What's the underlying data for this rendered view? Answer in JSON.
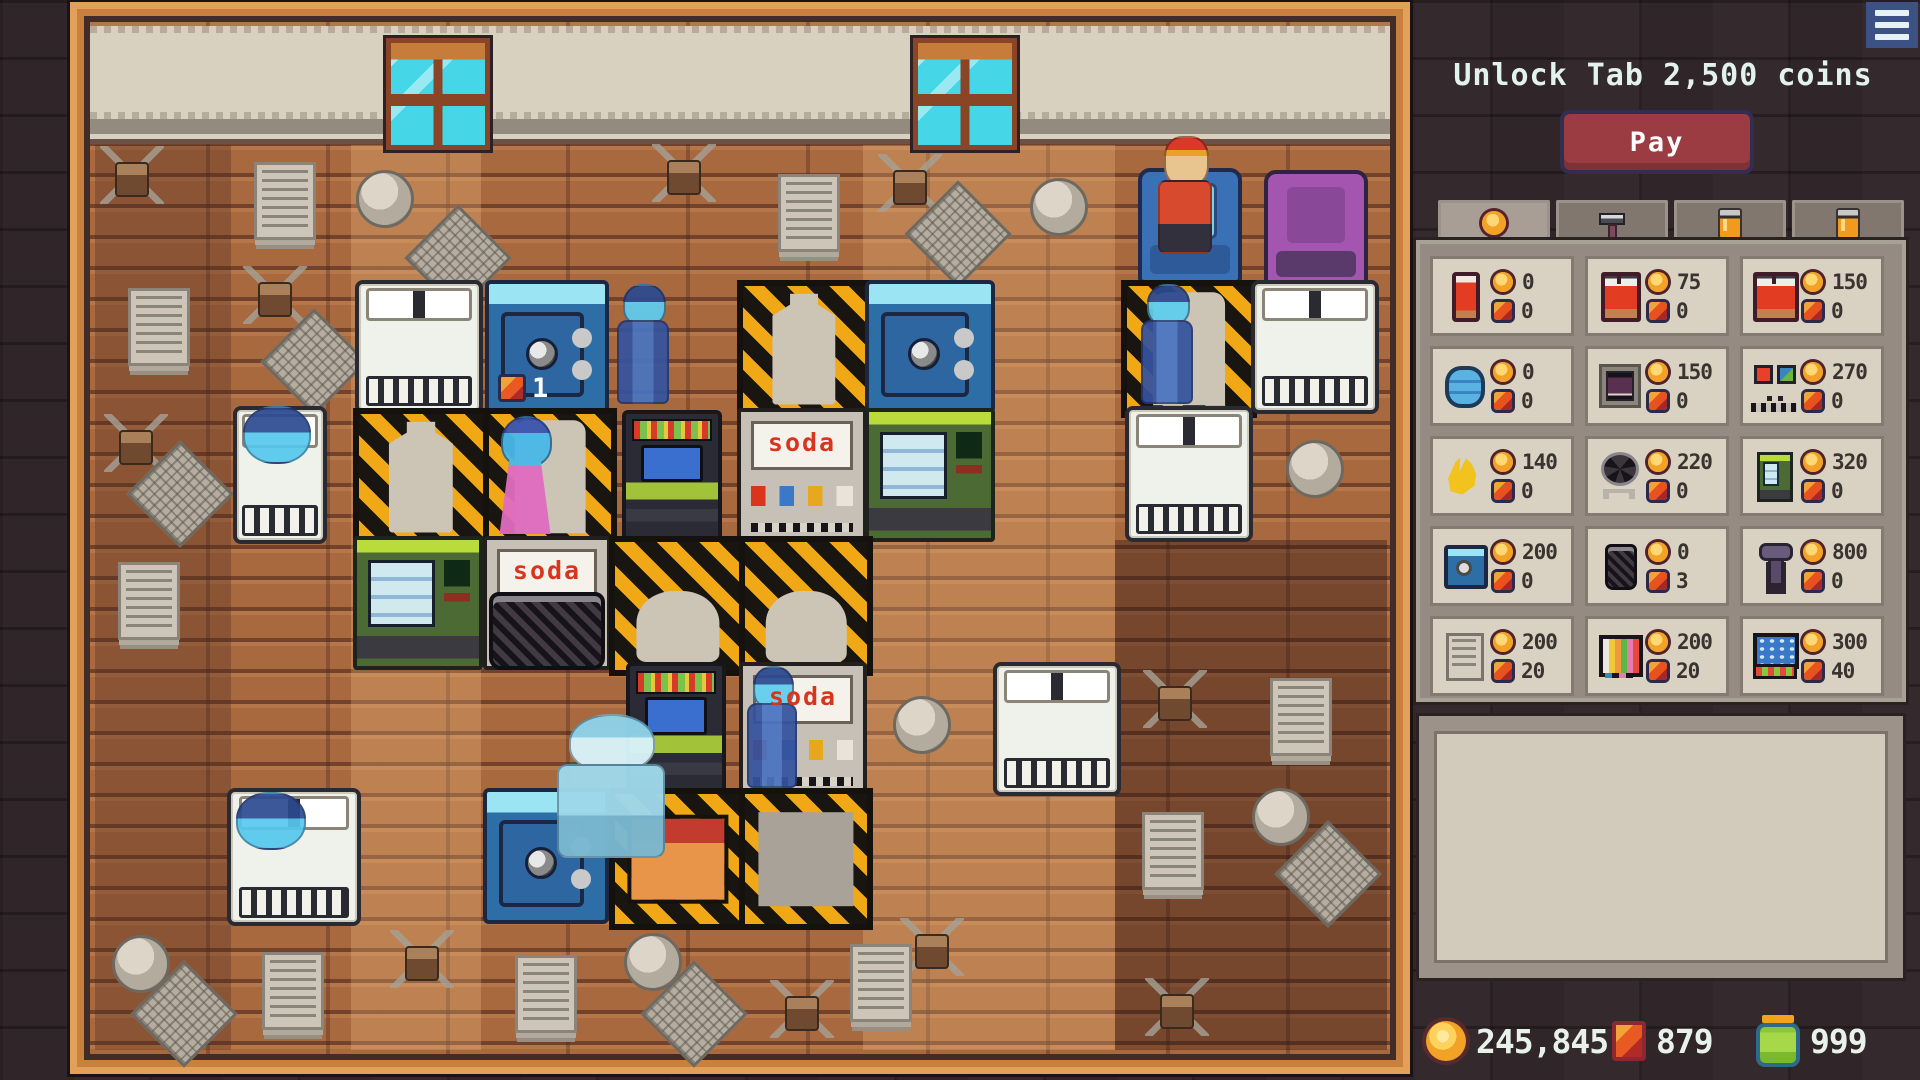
{
  "header": {
    "unlock_text": "Unlock Tab 2,500 coins",
    "pay_label": "Pay"
  },
  "menu": {
    "icon": "hamburger"
  },
  "colors": {
    "accent_orange": "#f2a227",
    "gem_red": "#e85a22",
    "pay_red": "#9a3c42",
    "frame_orange": "#c8803f"
  },
  "tabs": [
    {
      "id": "coins",
      "icon": "coin",
      "active": true
    },
    {
      "id": "tools",
      "icon": "hammer",
      "active": false
    },
    {
      "id": "canister-1",
      "icon": "can",
      "active": false
    },
    {
      "id": "canister-2",
      "icon": "can",
      "active": false
    }
  ],
  "shop": {
    "items": [
      {
        "id": "bedroll",
        "icon": "bedroll",
        "coin": "0",
        "gem": "0"
      },
      {
        "id": "red-bed",
        "icon": "bed",
        "coin": "75",
        "gem": "0"
      },
      {
        "id": "red-double-bed",
        "icon": "bigbed",
        "coin": "150",
        "gem": "0"
      },
      {
        "id": "water-tank",
        "icon": "water",
        "coin": "0",
        "gem": "0"
      },
      {
        "id": "furnace",
        "icon": "furnace",
        "coin": "150",
        "gem": "0"
      },
      {
        "id": "gate-buttons",
        "icon": "gate",
        "coin": "270",
        "gem": "0"
      },
      {
        "id": "bananas",
        "icon": "banana",
        "coin": "140",
        "gem": "0"
      },
      {
        "id": "fan",
        "icon": "fan",
        "coin": "220",
        "gem": "0"
      },
      {
        "id": "vending-machine",
        "icon": "vend",
        "coin": "320",
        "gem": "0"
      },
      {
        "id": "safe",
        "icon": "safe",
        "coin": "200",
        "gem": "0"
      },
      {
        "id": "trash-bin",
        "icon": "bin",
        "coin": "0",
        "gem": "3"
      },
      {
        "id": "lever",
        "icon": "lever",
        "coin": "800",
        "gem": "0"
      },
      {
        "id": "newspaper",
        "icon": "paper",
        "coin": "200",
        "gem": "20"
      },
      {
        "id": "tv",
        "icon": "tv",
        "coin": "200",
        "gem": "20"
      },
      {
        "id": "arcade-machine",
        "icon": "arcade",
        "coin": "300",
        "gem": "40"
      }
    ]
  },
  "description_box": {
    "text": ""
  },
  "wallet": [
    {
      "icon": "coin",
      "value": "245,845",
      "x": 6
    },
    {
      "icon": "gem",
      "value": "879",
      "x": 192
    },
    {
      "icon": "energy",
      "value": "999",
      "x": 336
    }
  ],
  "game": {
    "bands": [
      {
        "tone": "dark",
        "x": 95,
        "y": 145,
        "w": 136,
        "h": 905
      },
      {
        "tone": "light",
        "x": 351,
        "y": 145,
        "w": 130,
        "h": 905
      },
      {
        "tone": "light",
        "x": 863,
        "y": 145,
        "w": 252,
        "h": 905
      },
      {
        "tone": "dark2",
        "x": 1115,
        "y": 540,
        "w": 272,
        "h": 510
      }
    ],
    "entities": [
      {
        "type": "window",
        "x": 386,
        "y": 38,
        "w": 94,
        "h": 102
      },
      {
        "type": "window",
        "x": 913,
        "y": 38,
        "w": 94,
        "h": 102
      },
      {
        "type": "chair-blue",
        "x": 1138,
        "y": 168,
        "w": 96,
        "h": 108
      },
      {
        "type": "bellhop",
        "x": 1154,
        "y": 136,
        "w": 62,
        "h": 118
      },
      {
        "type": "chair-purple",
        "x": 1264,
        "y": 170,
        "w": 96,
        "h": 108
      },
      {
        "type": "bed-double",
        "x": 355,
        "y": 280,
        "w": 120,
        "h": 126
      },
      {
        "type": "safe",
        "x": 485,
        "y": 280,
        "w": 116,
        "h": 126
      },
      {
        "type": "badge",
        "x": 498,
        "y": 372,
        "w": 70,
        "h": 32,
        "label": "1"
      },
      {
        "type": "ghost-man",
        "x": 614,
        "y": 284,
        "w": 58,
        "h": 120
      },
      {
        "type": "construction",
        "sil": "bottle",
        "x": 737,
        "y": 280,
        "w": 122,
        "h": 126
      },
      {
        "type": "safe",
        "x": 865,
        "y": 280,
        "w": 122,
        "h": 126
      },
      {
        "type": "construction",
        "sil": "door",
        "x": 1121,
        "y": 280,
        "w": 124,
        "h": 126
      },
      {
        "type": "ghost-man",
        "x": 1138,
        "y": 284,
        "w": 58,
        "h": 120
      },
      {
        "type": "bed-double",
        "x": 1251,
        "y": 280,
        "w": 120,
        "h": 126
      },
      {
        "type": "bed-single",
        "x": 233,
        "y": 406,
        "w": 86,
        "h": 130
      },
      {
        "type": "ghost-sleep",
        "x": 243,
        "y": 406,
        "w": 64,
        "h": 54
      },
      {
        "type": "construction",
        "sil": "bottle",
        "x": 353,
        "y": 408,
        "w": 124,
        "h": 126
      },
      {
        "type": "construction",
        "sil": "door",
        "x": 483,
        "y": 408,
        "w": 122,
        "h": 126
      },
      {
        "type": "ghost-woman",
        "x": 492,
        "y": 416,
        "w": 66,
        "h": 118
      },
      {
        "type": "arcade",
        "x": 622,
        "y": 410,
        "w": 92,
        "h": 122
      },
      {
        "type": "soda",
        "x": 737,
        "y": 408,
        "w": 122,
        "h": 126,
        "label": "soda"
      },
      {
        "type": "vending",
        "x": 865,
        "y": 408,
        "w": 122,
        "h": 126
      },
      {
        "type": "bed-double",
        "x": 1125,
        "y": 406,
        "w": 120,
        "h": 128
      },
      {
        "type": "vending",
        "x": 353,
        "y": 536,
        "w": 122,
        "h": 126
      },
      {
        "type": "soda",
        "x": 483,
        "y": 536,
        "w": 120,
        "h": 126,
        "label": "soda"
      },
      {
        "type": "construction",
        "sil": "blob",
        "x": 609,
        "y": 536,
        "w": 126,
        "h": 128
      },
      {
        "type": "construction",
        "sil": "blob",
        "x": 739,
        "y": 536,
        "w": 122,
        "h": 128
      },
      {
        "type": "trash",
        "x": 489,
        "y": 592,
        "w": 108,
        "h": 70
      },
      {
        "type": "arcade",
        "x": 626,
        "y": 662,
        "w": 92,
        "h": 124
      },
      {
        "type": "soda",
        "x": 739,
        "y": 662,
        "w": 120,
        "h": 126,
        "label": "soda"
      },
      {
        "type": "ghost-man",
        "x": 744,
        "y": 666,
        "w": 56,
        "h": 122
      },
      {
        "type": "bed-double",
        "x": 993,
        "y": 662,
        "w": 120,
        "h": 126
      },
      {
        "type": "bed-double",
        "x": 227,
        "y": 788,
        "w": 126,
        "h": 130
      },
      {
        "type": "ghost-sleep",
        "x": 236,
        "y": 792,
        "w": 66,
        "h": 54
      },
      {
        "type": "safe",
        "x": 483,
        "y": 788,
        "w": 118,
        "h": 128
      },
      {
        "type": "construction",
        "sil": "crate",
        "x": 609,
        "y": 788,
        "w": 126,
        "h": 130
      },
      {
        "type": "construction",
        "sil": "slab",
        "x": 739,
        "y": 788,
        "w": 122,
        "h": 130
      },
      {
        "type": "worker",
        "x": 552,
        "y": 714,
        "w": 118,
        "h": 150
      }
    ],
    "decor": [
      {
        "type": "cobweb",
        "x": 100,
        "y": 146
      },
      {
        "type": "cobweb",
        "x": 652,
        "y": 144
      },
      {
        "type": "cobweb",
        "x": 878,
        "y": 154
      },
      {
        "type": "cobweb",
        "x": 243,
        "y": 266
      },
      {
        "type": "cobweb",
        "x": 104,
        "y": 414
      },
      {
        "type": "cobweb",
        "x": 1143,
        "y": 670
      },
      {
        "type": "cobweb",
        "x": 390,
        "y": 930
      },
      {
        "type": "cobweb",
        "x": 900,
        "y": 918
      },
      {
        "type": "cobweb",
        "x": 770,
        "y": 980
      },
      {
        "type": "cobweb",
        "x": 1145,
        "y": 978
      },
      {
        "type": "paper",
        "x": 254,
        "y": 162
      },
      {
        "type": "paper",
        "x": 778,
        "y": 174
      },
      {
        "type": "paper",
        "x": 128,
        "y": 288
      },
      {
        "type": "paper",
        "x": 118,
        "y": 562
      },
      {
        "type": "paper",
        "x": 1270,
        "y": 678
      },
      {
        "type": "paper",
        "x": 1142,
        "y": 812
      },
      {
        "type": "paper",
        "x": 262,
        "y": 952
      },
      {
        "type": "paper",
        "x": 515,
        "y": 955
      },
      {
        "type": "paper",
        "x": 850,
        "y": 944
      },
      {
        "type": "ball",
        "x": 356,
        "y": 170
      },
      {
        "type": "ball",
        "x": 1030,
        "y": 178
      },
      {
        "type": "ball",
        "x": 1286,
        "y": 440
      },
      {
        "type": "ball",
        "x": 893,
        "y": 696
      },
      {
        "type": "ball",
        "x": 744,
        "y": 574
      },
      {
        "type": "ball",
        "x": 1252,
        "y": 788
      },
      {
        "type": "ball",
        "x": 112,
        "y": 935
      },
      {
        "type": "ball",
        "x": 624,
        "y": 933
      },
      {
        "type": "mat",
        "x": 276,
        "y": 324
      },
      {
        "type": "mat",
        "x": 142,
        "y": 456
      },
      {
        "type": "mat",
        "x": 920,
        "y": 196
      },
      {
        "type": "mat",
        "x": 1290,
        "y": 836
      },
      {
        "type": "mat",
        "x": 146,
        "y": 976
      },
      {
        "type": "mat",
        "x": 656,
        "y": 976
      },
      {
        "type": "mat",
        "x": 420,
        "y": 220
      }
    ]
  }
}
